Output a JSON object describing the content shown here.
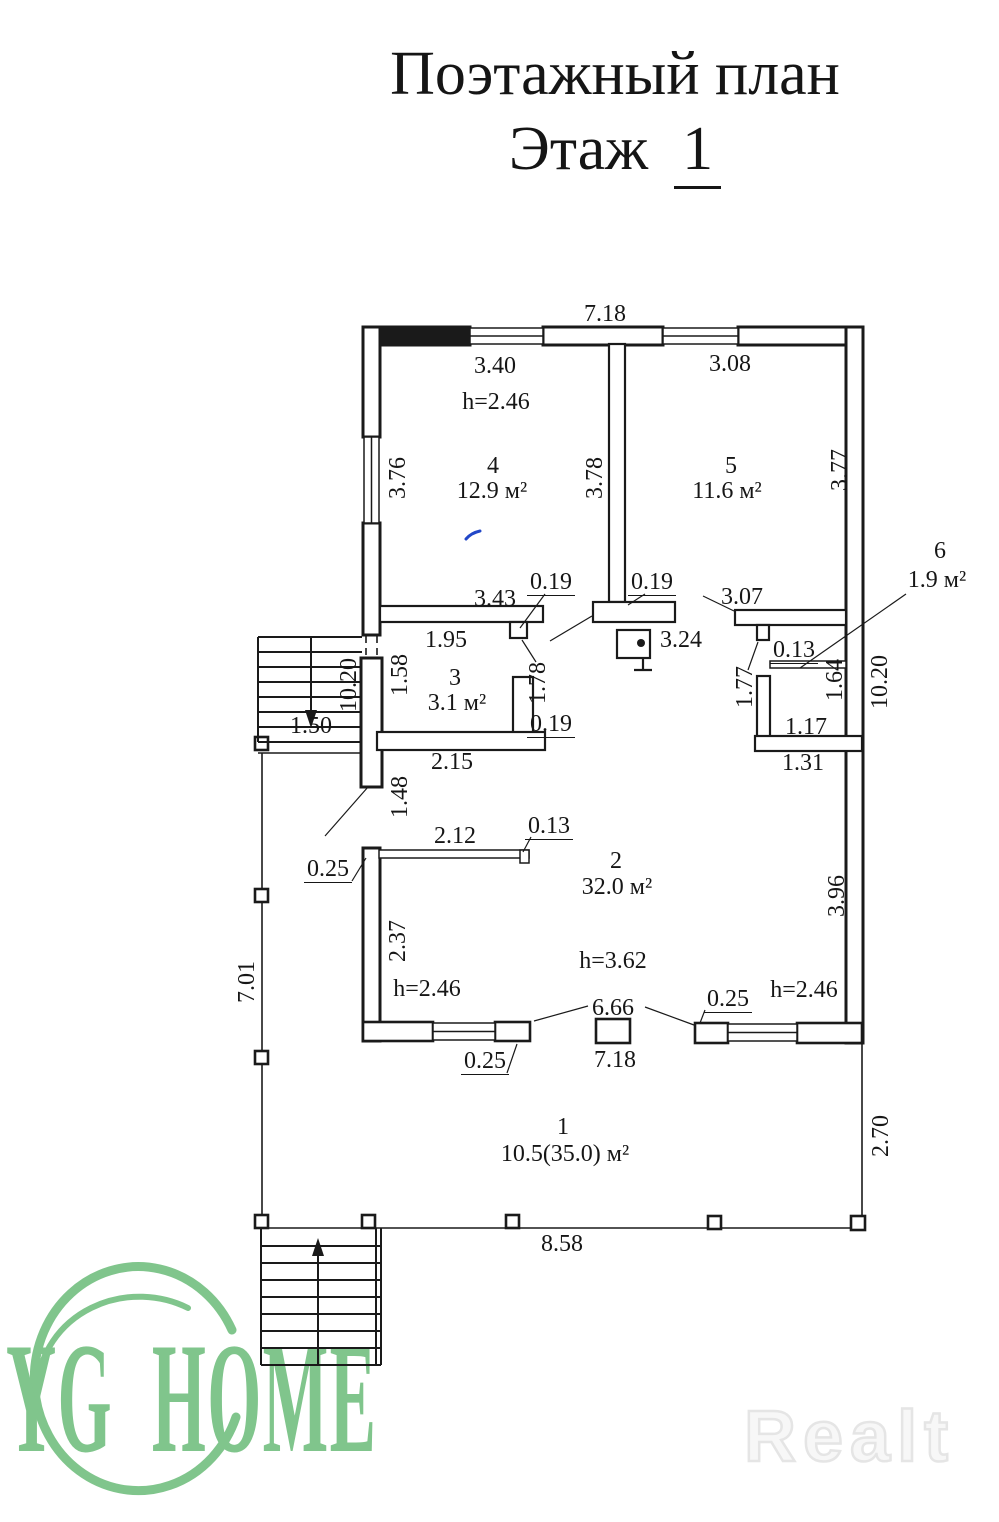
{
  "title": {
    "line1": "Поэтажный план",
    "floor_word": "Этаж",
    "floor_number": "1"
  },
  "watermarks": {
    "agency": "YG HOME",
    "portal": "Realt"
  },
  "colors": {
    "ink": "#1a1a1a",
    "watermark_green": "#80c58c",
    "portal_outline_gray": "#e5e5e5",
    "pen_blue": "#2247c8"
  },
  "rooms": [
    {
      "number": "1",
      "area_label": "10.5(35.0) м²"
    },
    {
      "number": "2",
      "area_label": "32.0 м²",
      "height_label": "h=3.62"
    },
    {
      "number": "3",
      "area_label": "3.1 м²"
    },
    {
      "number": "4",
      "area_label": "12.9 м²",
      "height_label": "h=2.46"
    },
    {
      "number": "5",
      "area_label": "11.6 м²"
    },
    {
      "number": "6",
      "area_label": "1.9 м²"
    }
  ],
  "labels": [
    {
      "t": "7.18",
      "x": 605,
      "y": 314
    },
    {
      "t": "3.40",
      "x": 495,
      "y": 366
    },
    {
      "t": "3.08",
      "x": 730,
      "y": 364
    },
    {
      "t": "h=2.46",
      "x": 496,
      "y": 402,
      "n": "ceiling-height-room4"
    },
    {
      "t": "4",
      "x": 493,
      "y": 466,
      "n": "room-4-number"
    },
    {
      "t": "12.9 м²",
      "x": 492,
      "y": 491,
      "n": "room-4-area"
    },
    {
      "t": "5",
      "x": 731,
      "y": 466,
      "n": "room-5-number"
    },
    {
      "t": "11.6 м²",
      "x": 727,
      "y": 491,
      "n": "room-5-area"
    },
    {
      "t": "3.76",
      "x": 398,
      "y": 478,
      "rot": true
    },
    {
      "t": "3.78",
      "x": 595,
      "y": 478,
      "rot": true
    },
    {
      "t": "3.77",
      "x": 840,
      "y": 470,
      "rot": true
    },
    {
      "t": "6",
      "x": 940,
      "y": 551,
      "n": "room-6-number"
    },
    {
      "t": "1.9 м²",
      "x": 937,
      "y": 580,
      "n": "room-6-area"
    },
    {
      "t": "3.43",
      "x": 495,
      "y": 599
    },
    {
      "t": "0.19",
      "x": 551,
      "y": 583,
      "ul": true
    },
    {
      "t": "0.19",
      "x": 652,
      "y": 583,
      "ul": true
    },
    {
      "t": "3.07",
      "x": 742,
      "y": 597
    },
    {
      "t": "1.95",
      "x": 446,
      "y": 640
    },
    {
      "t": "3.24",
      "x": 681,
      "y": 640
    },
    {
      "t": "0.13",
      "x": 794,
      "y": 651,
      "ul": true
    },
    {
      "t": "1.58",
      "x": 400,
      "y": 675,
      "rot": true
    },
    {
      "t": "3",
      "x": 455,
      "y": 678,
      "n": "room-3-number"
    },
    {
      "t": "3.1 м²",
      "x": 457,
      "y": 703,
      "n": "room-3-area"
    },
    {
      "t": "1.78",
      "x": 538,
      "y": 683,
      "rot": true
    },
    {
      "t": "1.64",
      "x": 835,
      "y": 680,
      "rot": true
    },
    {
      "t": "10.20",
      "x": 880,
      "y": 682,
      "rot": true
    },
    {
      "t": "10.20",
      "x": 349,
      "y": 685,
      "rot": true
    },
    {
      "t": "1.50",
      "x": 311,
      "y": 726
    },
    {
      "t": "1.17",
      "x": 806,
      "y": 727
    },
    {
      "t": "0.19",
      "x": 551,
      "y": 725,
      "ul": true
    },
    {
      "t": "2.15",
      "x": 452,
      "y": 762
    },
    {
      "t": "1.31",
      "x": 803,
      "y": 763
    },
    {
      "t": "1.48",
      "x": 400,
      "y": 797,
      "rot": true
    },
    {
      "t": "1.77",
      "x": 745,
      "y": 687,
      "rot": true
    },
    {
      "t": "2.12",
      "x": 455,
      "y": 836
    },
    {
      "t": "0.13",
      "x": 549,
      "y": 827,
      "ul": true
    },
    {
      "t": "0.25",
      "x": 328,
      "y": 870,
      "ul": true
    },
    {
      "t": "2",
      "x": 616,
      "y": 861,
      "n": "room-2-number"
    },
    {
      "t": "32.0 м²",
      "x": 617,
      "y": 887,
      "n": "room-2-area"
    },
    {
      "t": "2.37",
      "x": 398,
      "y": 941,
      "rot": true
    },
    {
      "t": "h=2.46",
      "x": 427,
      "y": 989,
      "n": "ceiling-height-room2-left"
    },
    {
      "t": "h=3.62",
      "x": 613,
      "y": 961,
      "n": "ceiling-height-room2"
    },
    {
      "t": "3.96",
      "x": 837,
      "y": 896,
      "rot": true
    },
    {
      "t": "h=2.46",
      "x": 804,
      "y": 990,
      "n": "ceiling-height-room2-right"
    },
    {
      "t": "0.25",
      "x": 728,
      "y": 1000,
      "ul": true
    },
    {
      "t": "6.66",
      "x": 613,
      "y": 1008
    },
    {
      "t": "0.25",
      "x": 485,
      "y": 1062,
      "ul": true
    },
    {
      "t": "7.18",
      "x": 615,
      "y": 1060
    },
    {
      "t": "1",
      "x": 563,
      "y": 1127,
      "n": "room-1-number"
    },
    {
      "t": "10.5(35.0) м²",
      "x": 565,
      "y": 1154,
      "n": "room-1-area"
    },
    {
      "t": "7.01",
      "x": 247,
      "y": 982,
      "rot": true
    },
    {
      "t": "2.70",
      "x": 881,
      "y": 1136,
      "rot": true
    },
    {
      "t": "8.58",
      "x": 562,
      "y": 1244
    }
  ]
}
